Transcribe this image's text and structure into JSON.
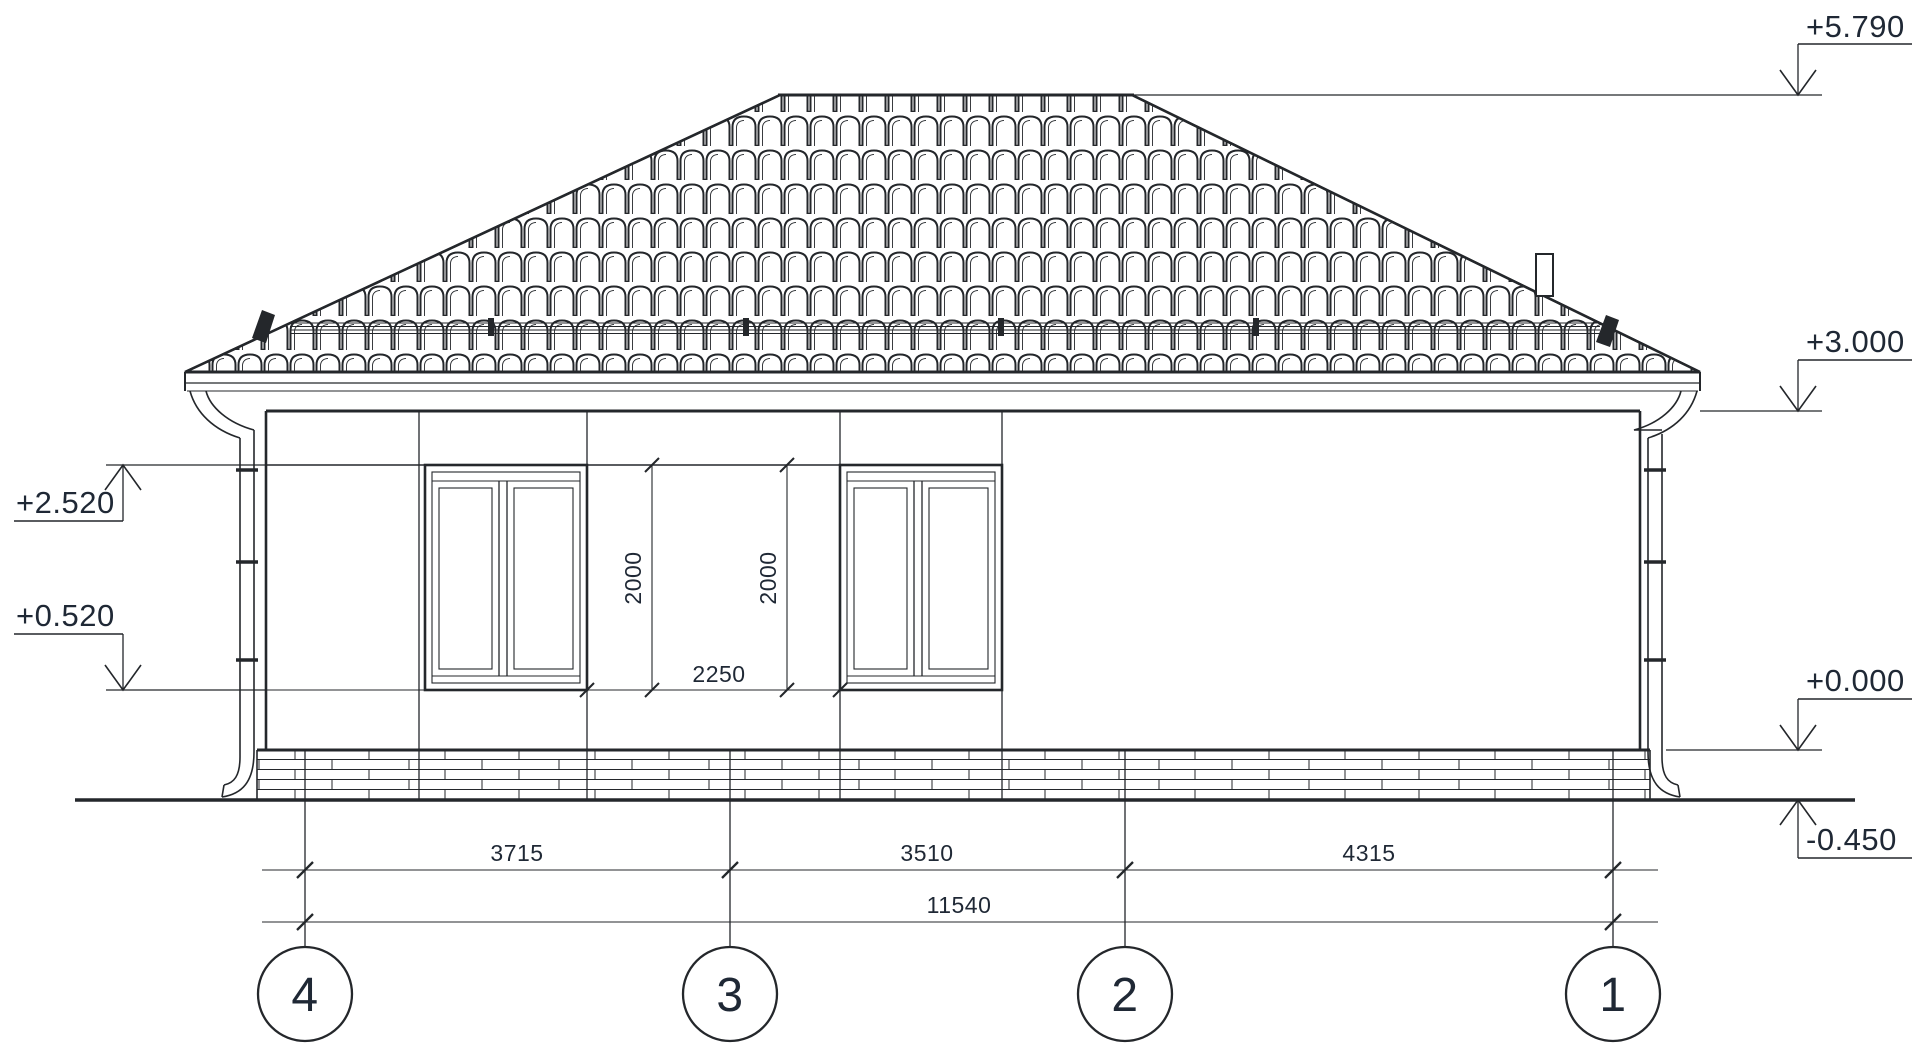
{
  "drawing": {
    "type": "architectural-elevation",
    "subject": "single-storey house facade with hipped tile roof",
    "colors": {
      "ink": "#24272b",
      "text": "#1f2835",
      "background": "#ffffff"
    },
    "levels": {
      "ridge": "+5.790",
      "eaves": "+3.000",
      "window_head": "+2.520",
      "window_sill": "+0.520",
      "floor": "+0.000",
      "ground": "-0.450"
    },
    "dimensions": {
      "window_height_left": "2000",
      "window_height_right": "2000",
      "between_windows": "2250",
      "span_axis4_axis3": "3715",
      "span_axis3_axis2": "3510",
      "span_axis2_axis1": "4315",
      "total_span": "11540"
    },
    "axes": {
      "a4": "4",
      "a3": "3",
      "a2": "2",
      "a1": "1"
    }
  }
}
